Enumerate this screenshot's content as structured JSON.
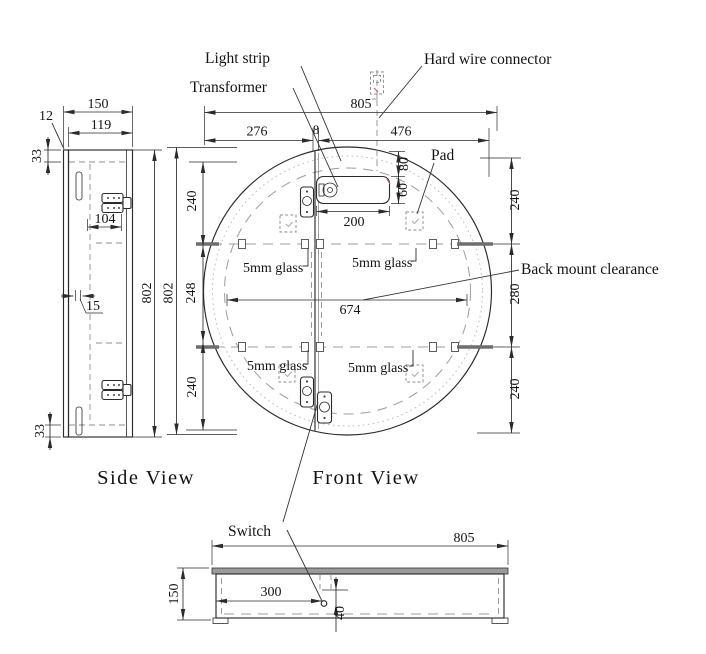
{
  "annotations": {
    "light_strip": "Light strip",
    "transformer": "Transformer",
    "hard_wire_connector": "Hard wire connector",
    "pad": "Pad",
    "back_mount_clearance": "Back mount clearance",
    "switch": "Switch",
    "glass": "5mm glass"
  },
  "views": {
    "side": {
      "label": "Side View",
      "dims": {
        "overall_depth": "150",
        "door_thickness": "12",
        "inner_depth": "119",
        "top_offset": "33",
        "hinge_inset": "104",
        "mirror_reveal": "15",
        "bottom_offset": "33",
        "cabinet_height": "802",
        "mirror_height": "802"
      }
    },
    "front": {
      "label": "Front View",
      "dims": {
        "overall_width": "805",
        "left_to_door_split": "276",
        "door_gap": "8",
        "door_split_to_right": "476",
        "top_to_transformer": "80",
        "transformer_height": "60",
        "transformer_width": "200",
        "left_top": "240",
        "left_middle": "248",
        "left_bottom": "240",
        "right_top": "240",
        "right_middle": "280",
        "right_bottom": "240",
        "back_mount_clearance_width": "674"
      }
    },
    "bottom": {
      "dims": {
        "overall_width": "805",
        "depth": "150",
        "switch_from_left": "300",
        "switch_offset": "40"
      }
    }
  }
}
